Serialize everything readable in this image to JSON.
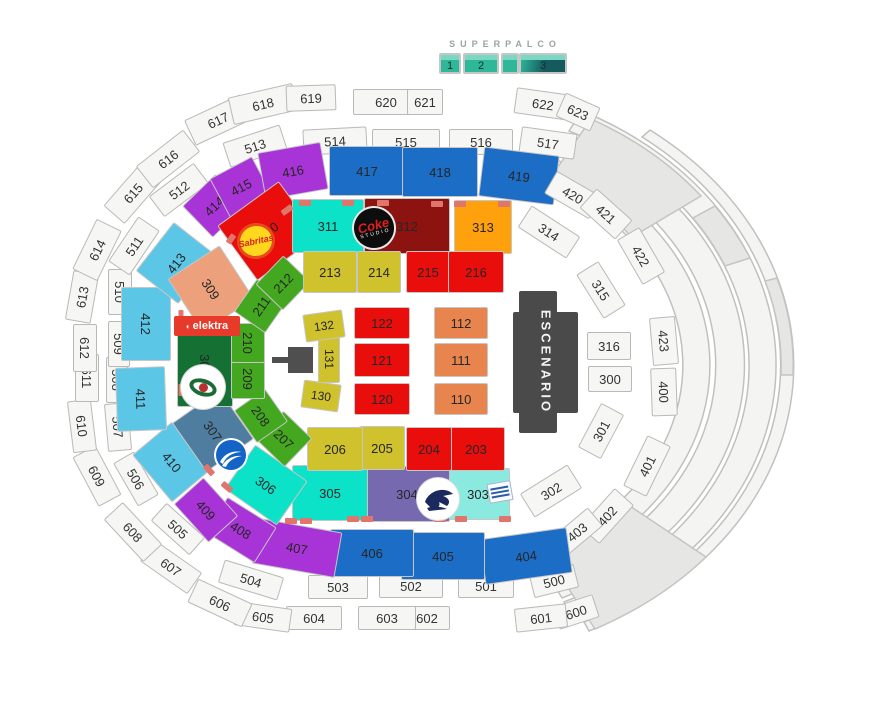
{
  "superpalco": {
    "label": "SUPERPALCO",
    "boxes": [
      {
        "label": "1",
        "x": 450,
        "w": 22,
        "dark": false
      },
      {
        "label": "2",
        "x": 481,
        "w": 36,
        "dark": false
      },
      {
        "label": "",
        "x": 510,
        "w": 18,
        "dark": false
      },
      {
        "label": "3",
        "x": 543,
        "w": 48,
        "dark": true
      }
    ]
  },
  "stage": {
    "label": "ESCENARIO"
  },
  "logos": {
    "sabritas": {
      "text": "Sabritas"
    },
    "coke": {
      "line1": "Coke",
      "line2": "STUDIO"
    },
    "elektra": {
      "icon": "swirl-icon",
      "text": "elektra"
    },
    "eye": {
      "name": "eye-logo"
    },
    "swoosh": {
      "name": "swoosh-logo"
    },
    "eagle": {
      "name": "eagle-logo"
    },
    "tilted": {
      "name": "tilted-label-logo"
    }
  },
  "colors": {
    "white": {
      "bg": "#f6f6f4",
      "br": "#b9b9b6"
    },
    "blue": {
      "bg": "#1b6dc5",
      "br": "#c6c6c6"
    },
    "lightblue": {
      "bg": "#5cc6e6",
      "br": "#c6c6c6"
    },
    "purple": {
      "bg": "#a833d6",
      "br": "#c6c6c6"
    },
    "cyan": {
      "bg": "#0be2c8",
      "br": "#c6c6c6"
    },
    "lightcyan": {
      "bg": "#8aeadf",
      "br": "#c6c6c6"
    },
    "steelblue": {
      "bg": "#4e7da0",
      "br": "#c6c6c6"
    },
    "mediumpurple": {
      "bg": "#7769b0",
      "br": "#c6c6c6"
    },
    "darkgreen": {
      "bg": "#157034",
      "br": "#c6c6c6"
    },
    "green": {
      "bg": "#43a81f",
      "br": "#c6c6c6"
    },
    "peach": {
      "bg": "#eca17c",
      "br": "#c6c6c6"
    },
    "salmon": {
      "bg": "#e8854f",
      "br": "#c6c6c6"
    },
    "red": {
      "bg": "#e90d0c",
      "br": "#c6c6c6"
    },
    "darkred": {
      "bg": "#8c1310",
      "br": "#c6c6c6"
    },
    "orange": {
      "bg": "#ffa00d",
      "br": "#c6c6c6"
    },
    "darkyellow": {
      "bg": "#cfc22d",
      "br": "#c6c6c6"
    },
    "marker": {
      "bg": "#e0766b",
      "br": "#e0766b"
    },
    "spteal": {
      "bg": "#2fb79a",
      "br": "#79d7c2"
    },
    "spdark": {
      "bg": "#155a5e",
      "br": "#79d7c2"
    }
  },
  "sections": [
    {
      "id": "600",
      "x": 576,
      "y": 612,
      "w": 42,
      "h": 24,
      "r": -18,
      "c": "white"
    },
    {
      "id": "601",
      "x": 541,
      "y": 618,
      "w": 52,
      "h": 24,
      "r": -6,
      "c": "white"
    },
    {
      "id": "602",
      "x": 427,
      "y": 618,
      "w": 46,
      "h": 24,
      "r": 0,
      "c": "white"
    },
    {
      "id": "603",
      "x": 387,
      "y": 618,
      "w": 58,
      "h": 24,
      "r": 0,
      "c": "white"
    },
    {
      "id": "604",
      "x": 314,
      "y": 618,
      "w": 56,
      "h": 24,
      "r": 0,
      "c": "white"
    },
    {
      "id": "605",
      "x": 263,
      "y": 617,
      "w": 56,
      "h": 24,
      "r": 8,
      "c": "white"
    },
    {
      "id": "606",
      "x": 220,
      "y": 603,
      "w": 60,
      "h": 26,
      "r": 25,
      "c": "white"
    },
    {
      "id": "607",
      "x": 171,
      "y": 567,
      "w": 58,
      "h": 26,
      "r": 35,
      "c": "white"
    },
    {
      "id": "608",
      "x": 133,
      "y": 532,
      "w": 58,
      "h": 26,
      "r": 47,
      "c": "white"
    },
    {
      "id": "609",
      "x": 97,
      "y": 476,
      "w": 56,
      "h": 26,
      "r": 62,
      "c": "white"
    },
    {
      "id": "610",
      "x": 82,
      "y": 426,
      "w": 52,
      "h": 24,
      "r": 83,
      "c": "white"
    },
    {
      "id": "611",
      "x": 87,
      "y": 378,
      "w": 48,
      "h": 24,
      "r": 90,
      "c": "white"
    },
    {
      "id": "612",
      "x": 85,
      "y": 348,
      "w": 48,
      "h": 24,
      "r": 90,
      "c": "white"
    },
    {
      "id": "613",
      "x": 82,
      "y": 297,
      "w": 50,
      "h": 26,
      "r": -80,
      "c": "white"
    },
    {
      "id": "614",
      "x": 97,
      "y": 250,
      "w": 56,
      "h": 28,
      "r": -64,
      "c": "white"
    },
    {
      "id": "615",
      "x": 133,
      "y": 193,
      "w": 58,
      "h": 28,
      "r": -49,
      "c": "white"
    },
    {
      "id": "616",
      "x": 168,
      "y": 159,
      "w": 60,
      "h": 28,
      "r": -38,
      "c": "white"
    },
    {
      "id": "617",
      "x": 218,
      "y": 120,
      "w": 62,
      "h": 28,
      "r": -25,
      "c": "white"
    },
    {
      "id": "618",
      "x": 263,
      "y": 104,
      "w": 66,
      "h": 28,
      "r": -13,
      "c": "white"
    },
    {
      "id": "619",
      "x": 311,
      "y": 98,
      "w": 50,
      "h": 26,
      "r": -2,
      "c": "white"
    },
    {
      "id": "620",
      "x": 386,
      "y": 102,
      "w": 66,
      "h": 26,
      "r": 0,
      "c": "white"
    },
    {
      "id": "621",
      "x": 425,
      "y": 102,
      "w": 36,
      "h": 26,
      "r": 0,
      "c": "white"
    },
    {
      "id": "622",
      "x": 543,
      "y": 104,
      "w": 56,
      "h": 26,
      "r": 8,
      "c": "white"
    },
    {
      "id": "623",
      "x": 578,
      "y": 112,
      "w": 38,
      "h": 26,
      "r": 24,
      "c": "white"
    },
    {
      "id": "500",
      "x": 554,
      "y": 581,
      "w": 46,
      "h": 24,
      "r": -14,
      "c": "white"
    },
    {
      "id": "501",
      "x": 486,
      "y": 586,
      "w": 56,
      "h": 24,
      "r": 0,
      "c": "white"
    },
    {
      "id": "502",
      "x": 411,
      "y": 586,
      "w": 64,
      "h": 24,
      "r": 0,
      "c": "white"
    },
    {
      "id": "503",
      "x": 338,
      "y": 587,
      "w": 60,
      "h": 24,
      "r": 0,
      "c": "white"
    },
    {
      "id": "504",
      "x": 251,
      "y": 580,
      "w": 62,
      "h": 24,
      "r": 17,
      "c": "white"
    },
    {
      "id": "505",
      "x": 178,
      "y": 529,
      "w": 52,
      "h": 24,
      "r": 42,
      "c": "white"
    },
    {
      "id": "506",
      "x": 136,
      "y": 479,
      "w": 50,
      "h": 24,
      "r": 60,
      "c": "white"
    },
    {
      "id": "507",
      "x": 118,
      "y": 427,
      "w": 48,
      "h": 24,
      "r": 85,
      "c": "white"
    },
    {
      "id": "508",
      "x": 117,
      "y": 380,
      "w": 46,
      "h": 22,
      "r": 90,
      "c": "white"
    },
    {
      "id": "509",
      "x": 119,
      "y": 344,
      "w": 46,
      "h": 22,
      "r": 90,
      "c": "white"
    },
    {
      "id": "510",
      "x": 120,
      "y": 292,
      "w": 46,
      "h": 24,
      "r": 90,
      "c": "white"
    },
    {
      "id": "511",
      "x": 134,
      "y": 246,
      "w": 54,
      "h": 26,
      "r": -56,
      "c": "white"
    },
    {
      "id": "512",
      "x": 179,
      "y": 190,
      "w": 56,
      "h": 26,
      "r": -37,
      "c": "white"
    },
    {
      "id": "513",
      "x": 255,
      "y": 146,
      "w": 60,
      "h": 26,
      "r": -18,
      "c": "white"
    },
    {
      "id": "514",
      "x": 335,
      "y": 141,
      "w": 64,
      "h": 26,
      "r": -3,
      "c": "white"
    },
    {
      "id": "515",
      "x": 406,
      "y": 142,
      "w": 68,
      "h": 26,
      "r": 0,
      "c": "white"
    },
    {
      "id": "516",
      "x": 481,
      "y": 142,
      "w": 64,
      "h": 26,
      "r": 0,
      "c": "white"
    },
    {
      "id": "517",
      "x": 548,
      "y": 143,
      "w": 56,
      "h": 26,
      "r": 8,
      "c": "white"
    },
    {
      "id": "400",
      "x": 664,
      "y": 392,
      "w": 48,
      "h": 26,
      "r": 88,
      "c": "white"
    },
    {
      "id": "401",
      "x": 647,
      "y": 466,
      "w": 56,
      "h": 26,
      "r": -64,
      "c": "white"
    },
    {
      "id": "402",
      "x": 607,
      "y": 516,
      "w": 52,
      "h": 26,
      "r": -48,
      "c": "white"
    },
    {
      "id": "403",
      "x": 577,
      "y": 532,
      "w": 48,
      "h": 24,
      "r": -40,
      "c": "white"
    },
    {
      "id": "404",
      "x": 526,
      "y": 556,
      "w": 88,
      "h": 46,
      "r": -8,
      "c": "blue"
    },
    {
      "id": "405",
      "x": 443,
      "y": 556,
      "w": 84,
      "h": 48,
      "r": 0,
      "c": "blue"
    },
    {
      "id": "406",
      "x": 372,
      "y": 553,
      "w": 84,
      "h": 48,
      "r": 0,
      "c": "blue"
    },
    {
      "id": "407",
      "x": 297,
      "y": 548,
      "w": 84,
      "h": 46,
      "r": 10,
      "c": "purple"
    },
    {
      "id": "408",
      "x": 241,
      "y": 530,
      "w": 58,
      "h": 42,
      "r": 32,
      "c": "purple"
    },
    {
      "id": "409",
      "x": 206,
      "y": 510,
      "w": 52,
      "h": 40,
      "r": 48,
      "c": "purple"
    },
    {
      "id": "410",
      "x": 172,
      "y": 462,
      "w": 62,
      "h": 52,
      "r": 50,
      "c": "lightblue"
    },
    {
      "id": "411",
      "x": 141,
      "y": 399,
      "w": 64,
      "h": 50,
      "r": 88,
      "c": "lightblue"
    },
    {
      "id": "412",
      "x": 146,
      "y": 324,
      "w": 74,
      "h": 50,
      "r": 90,
      "c": "lightblue"
    },
    {
      "id": "413",
      "x": 176,
      "y": 263,
      "w": 62,
      "h": 54,
      "r": -52,
      "c": "lightblue"
    },
    {
      "id": "414",
      "x": 214,
      "y": 206,
      "w": 46,
      "h": 44,
      "r": -44,
      "c": "purple"
    },
    {
      "id": "415",
      "x": 241,
      "y": 187,
      "w": 48,
      "h": 44,
      "r": -28,
      "c": "purple"
    },
    {
      "id": "416",
      "x": 293,
      "y": 171,
      "w": 64,
      "h": 48,
      "r": -10,
      "c": "purple"
    },
    {
      "id": "417",
      "x": 367,
      "y": 171,
      "w": 76,
      "h": 50,
      "r": 0,
      "c": "blue"
    },
    {
      "id": "418",
      "x": 440,
      "y": 172,
      "w": 76,
      "h": 50,
      "r": 0,
      "c": "blue"
    },
    {
      "id": "419",
      "x": 519,
      "y": 176,
      "w": 76,
      "h": 50,
      "r": 7,
      "c": "blue"
    },
    {
      "id": "420",
      "x": 573,
      "y": 195,
      "w": 52,
      "h": 26,
      "r": 30,
      "c": "white"
    },
    {
      "id": "421",
      "x": 606,
      "y": 214,
      "w": 48,
      "h": 26,
      "r": 42,
      "c": "white"
    },
    {
      "id": "422",
      "x": 641,
      "y": 256,
      "w": 52,
      "h": 26,
      "r": 60,
      "c": "white"
    },
    {
      "id": "423",
      "x": 664,
      "y": 341,
      "w": 48,
      "h": 26,
      "r": 85,
      "c": "white"
    },
    {
      "id": "300",
      "x": 610,
      "y": 379,
      "w": 44,
      "h": 26,
      "r": 0,
      "c": "white"
    },
    {
      "id": "301",
      "x": 601,
      "y": 431,
      "w": 50,
      "h": 26,
      "r": -62,
      "c": "white"
    },
    {
      "id": "302",
      "x": 551,
      "y": 491,
      "w": 56,
      "h": 28,
      "r": -32,
      "c": "white"
    },
    {
      "id": "303",
      "x": 478,
      "y": 494,
      "w": 64,
      "h": 52,
      "r": 0,
      "c": "lightcyan"
    },
    {
      "id": "304",
      "x": 407,
      "y": 494,
      "w": 86,
      "h": 56,
      "r": 0,
      "c": "mediumpurple"
    },
    {
      "id": "305",
      "x": 330,
      "y": 493,
      "w": 76,
      "h": 56,
      "r": 0,
      "c": "cyan"
    },
    {
      "id": "306",
      "x": 266,
      "y": 485,
      "w": 64,
      "h": 54,
      "r": 35,
      "c": "cyan"
    },
    {
      "id": "307",
      "x": 213,
      "y": 431,
      "w": 60,
      "h": 58,
      "r": 55,
      "c": "steelblue"
    },
    {
      "id": "308",
      "x": 205,
      "y": 365,
      "w": 84,
      "h": 56,
      "r": 90,
      "c": "darkgreen"
    },
    {
      "id": "309",
      "x": 211,
      "y": 289,
      "w": 64,
      "h": 62,
      "r": 57,
      "c": "peach"
    },
    {
      "id": "310",
      "x": 268,
      "y": 231,
      "w": 76,
      "h": 68,
      "r": -36,
      "c": "red"
    },
    {
      "id": "311",
      "x": 328,
      "y": 226,
      "w": 72,
      "h": 54,
      "r": 0,
      "c": "cyan"
    },
    {
      "id": "312",
      "x": 407,
      "y": 226,
      "w": 86,
      "h": 56,
      "r": 0,
      "c": "darkred"
    },
    {
      "id": "313",
      "x": 483,
      "y": 227,
      "w": 58,
      "h": 54,
      "r": 0,
      "c": "orange"
    },
    {
      "id": "314",
      "x": 549,
      "y": 232,
      "w": 58,
      "h": 26,
      "r": 33,
      "c": "white"
    },
    {
      "id": "315",
      "x": 601,
      "y": 290,
      "w": 52,
      "h": 26,
      "r": 58,
      "c": "white"
    },
    {
      "id": "316",
      "x": 609,
      "y": 346,
      "w": 44,
      "h": 28,
      "r": 0,
      "c": "white"
    },
    {
      "id": "203",
      "x": 476,
      "y": 449,
      "w": 58,
      "h": 44,
      "r": 0,
      "c": "red"
    },
    {
      "id": "204",
      "x": 429,
      "y": 449,
      "w": 46,
      "h": 44,
      "r": 0,
      "c": "red"
    },
    {
      "id": "205",
      "x": 382,
      "y": 448,
      "w": 46,
      "h": 44,
      "r": 0,
      "c": "darkyellow"
    },
    {
      "id": "206",
      "x": 335,
      "y": 449,
      "w": 56,
      "h": 44,
      "r": 0,
      "c": "darkyellow"
    },
    {
      "id": "207",
      "x": 284,
      "y": 439,
      "w": 40,
      "h": 40,
      "r": 44,
      "c": "green"
    },
    {
      "id": "208",
      "x": 261,
      "y": 416,
      "w": 40,
      "h": 38,
      "r": 55,
      "c": "green"
    },
    {
      "id": "209",
      "x": 248,
      "y": 379,
      "w": 40,
      "h": 34,
      "r": 90,
      "c": "green"
    },
    {
      "id": "210",
      "x": 248,
      "y": 343,
      "w": 40,
      "h": 34,
      "r": 90,
      "c": "green"
    },
    {
      "id": "211",
      "x": 261,
      "y": 306,
      "w": 40,
      "h": 38,
      "r": -55,
      "c": "green"
    },
    {
      "id": "212",
      "x": 283,
      "y": 283,
      "w": 40,
      "h": 38,
      "r": -46,
      "c": "green"
    },
    {
      "id": "213",
      "x": 330,
      "y": 272,
      "w": 54,
      "h": 42,
      "r": 0,
      "c": "darkyellow"
    },
    {
      "id": "214",
      "x": 379,
      "y": 272,
      "w": 44,
      "h": 42,
      "r": 0,
      "c": "darkyellow"
    },
    {
      "id": "215",
      "x": 428,
      "y": 272,
      "w": 44,
      "h": 42,
      "r": 0,
      "c": "red"
    },
    {
      "id": "216",
      "x": 476,
      "y": 272,
      "w": 56,
      "h": 42,
      "r": 0,
      "c": "red"
    },
    {
      "id": "110",
      "x": 461,
      "y": 399,
      "w": 54,
      "h": 32,
      "r": 0,
      "c": "salmon"
    },
    {
      "id": "111",
      "x": 461,
      "y": 360,
      "w": 54,
      "h": 34,
      "r": 0,
      "c": "salmon"
    },
    {
      "id": "112",
      "x": 461,
      "y": 323,
      "w": 54,
      "h": 32,
      "r": 0,
      "c": "salmon"
    },
    {
      "id": "120",
      "x": 382,
      "y": 399,
      "w": 56,
      "h": 32,
      "r": 0,
      "c": "red"
    },
    {
      "id": "121",
      "x": 382,
      "y": 360,
      "w": 56,
      "h": 34,
      "r": 0,
      "c": "red"
    },
    {
      "id": "122",
      "x": 382,
      "y": 323,
      "w": 56,
      "h": 32,
      "r": 0,
      "c": "red"
    },
    {
      "id": "130",
      "x": 321,
      "y": 396,
      "w": 38,
      "h": 28,
      "r": 8,
      "fs": 12,
      "c": "darkyellow"
    },
    {
      "id": "131",
      "x": 329,
      "y": 359,
      "w": 48,
      "h": 22,
      "r": 90,
      "fs": 12,
      "c": "darkyellow"
    },
    {
      "id": "132",
      "x": 324,
      "y": 326,
      "w": 40,
      "h": 28,
      "r": -8,
      "fs": 12,
      "c": "darkyellow"
    }
  ],
  "markers": [
    {
      "x": 305,
      "y": 203,
      "w": 12,
      "h": 6,
      "r": 0
    },
    {
      "x": 348,
      "y": 203,
      "w": 12,
      "h": 6,
      "r": 0
    },
    {
      "x": 383,
      "y": 203,
      "w": 12,
      "h": 6,
      "r": 0
    },
    {
      "x": 437,
      "y": 204,
      "w": 12,
      "h": 6,
      "r": 0
    },
    {
      "x": 460,
      "y": 204,
      "w": 12,
      "h": 6,
      "r": 0
    },
    {
      "x": 504,
      "y": 204,
      "w": 12,
      "h": 6,
      "r": 0
    },
    {
      "x": 287,
      "y": 210,
      "w": 12,
      "h": 6,
      "r": -36
    },
    {
      "x": 231,
      "y": 239,
      "w": 10,
      "h": 6,
      "r": -55
    },
    {
      "x": 181,
      "y": 316,
      "w": 5,
      "h": 12,
      "r": 0
    },
    {
      "x": 181,
      "y": 390,
      "w": 5,
      "h": 12,
      "r": 0
    },
    {
      "x": 209,
      "y": 470,
      "w": 12,
      "h": 6,
      "r": 48
    },
    {
      "x": 227,
      "y": 487,
      "w": 12,
      "h": 6,
      "r": 40
    },
    {
      "x": 291,
      "y": 521,
      "w": 12,
      "h": 6,
      "r": 0
    },
    {
      "x": 306,
      "y": 521,
      "w": 12,
      "h": 6,
      "r": 0
    },
    {
      "x": 353,
      "y": 519,
      "w": 12,
      "h": 6,
      "r": 0
    },
    {
      "x": 367,
      "y": 519,
      "w": 12,
      "h": 6,
      "r": 0
    },
    {
      "x": 440,
      "y": 519,
      "w": 12,
      "h": 6,
      "r": 0
    },
    {
      "x": 461,
      "y": 519,
      "w": 12,
      "h": 6,
      "r": 0
    },
    {
      "x": 505,
      "y": 519,
      "w": 12,
      "h": 6,
      "r": 0
    }
  ]
}
